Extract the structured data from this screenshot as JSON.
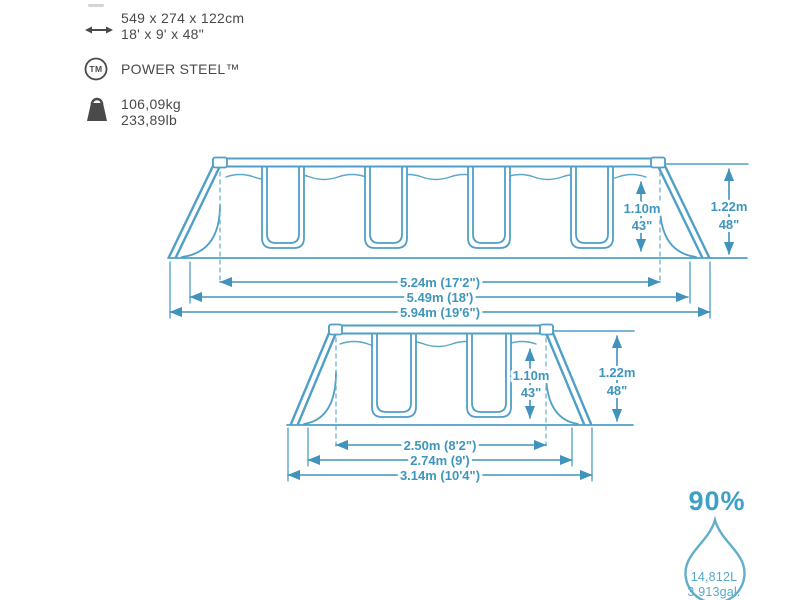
{
  "specs": {
    "dimensions_metric": "549 x 274 x 122cm",
    "dimensions_imperial": "18' x 9' x 48\"",
    "tm_badge": "TM",
    "brand": "POWER STEEL™",
    "weight_kg": "106,09kg",
    "weight_lb": "233,89lb"
  },
  "side_view": {
    "length_inner": "5.24m (17'2\")",
    "length_frame": "5.49m (18')",
    "length_total": "5.94m (19'6\")",
    "height_water_m": "1.10m",
    "height_water_in": "43\"",
    "height_total_m": "1.22m",
    "height_total_in": "48\""
  },
  "end_view": {
    "width_inner": "2.50m (8'2\")",
    "width_frame": "2.74m (9')",
    "width_total": "3.14m (10'4\")",
    "height_water_m": "1.10m",
    "height_water_in": "43\"",
    "height_total_m": "1.22m",
    "height_total_in": "48\""
  },
  "capacity": {
    "fill_percent": "90%",
    "volume_liters": "14,812L",
    "volume_gallons": "3,913gal."
  },
  "icons": {
    "size": "double-arrow-icon",
    "brand": "trademark-icon",
    "weight": "weight-icon",
    "capacity": "water-drop-icon"
  },
  "colors": {
    "line_blue": "#4f9fc6",
    "dim_text_blue": "#3f96bd",
    "capacity_teal": "#3da0c4",
    "spec_gray": "#4a4a4a"
  }
}
